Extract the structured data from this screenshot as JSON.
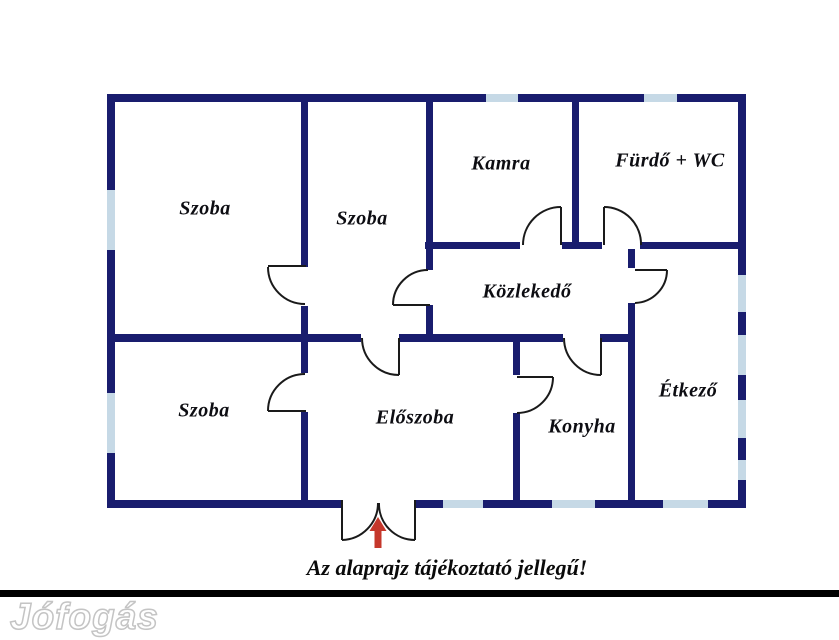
{
  "floorplan": {
    "rooms": [
      {
        "name": "szoba-top-left",
        "label": "Szoba"
      },
      {
        "name": "szoba-top-middle",
        "label": "Szoba"
      },
      {
        "name": "kamra",
        "label": "Kamra"
      },
      {
        "name": "furdo-wc",
        "label": "Fürdő + WC"
      },
      {
        "name": "kozlekedo",
        "label": "Közlekedő"
      },
      {
        "name": "szoba-bottom-left",
        "label": "Szoba"
      },
      {
        "name": "eloszoba",
        "label": "Előszoba"
      },
      {
        "name": "konyha",
        "label": "Konyha"
      },
      {
        "name": "etkezo",
        "label": "Étkező"
      }
    ],
    "caption": "Az alaprajz tájékoztató jellegű!",
    "watermark": "Jófogás",
    "entrance_arrow_direction": "up",
    "colors": {
      "wall": "#191d6e",
      "window": "#c6d9e6",
      "door_line": "#1a1a1a",
      "entrance_arrow": "#c5372b",
      "label_text": "#0d0d12",
      "separator_bar": "#000000",
      "background": "#ffffff",
      "watermark_fill": "#ffffff",
      "watermark_outline": "#c4c4c4"
    }
  }
}
